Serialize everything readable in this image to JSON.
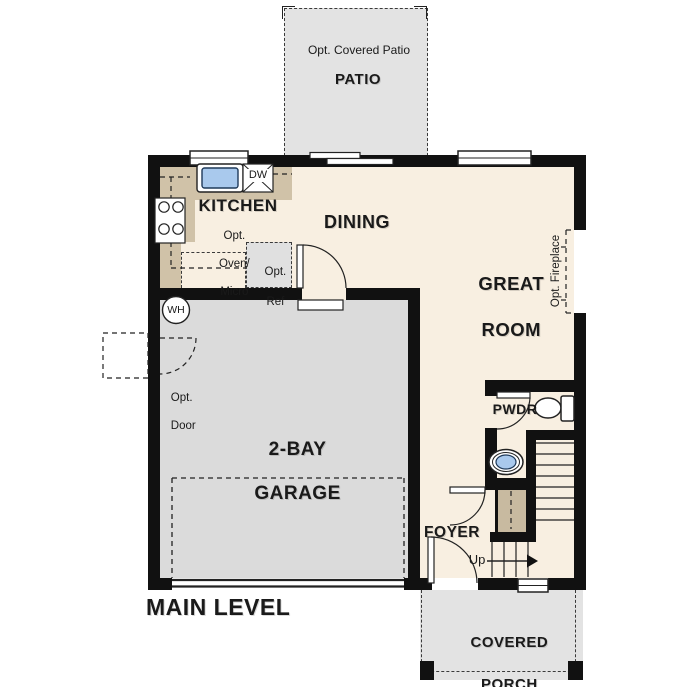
{
  "plan": {
    "title": "MAIN LEVEL",
    "kitchen": {
      "label": "KITCHEN",
      "note_line1": "Opt.",
      "note_line2": "Oven/",
      "note_line3": "Micro",
      "dw": "DW",
      "ref_line1": "Opt.",
      "ref_line2": "Ref"
    },
    "dining": {
      "label": "DINING"
    },
    "great_room": {
      "label_line1": "GREAT",
      "label_line2": "ROOM",
      "fireplace_note": "Opt. Fireplace"
    },
    "garage": {
      "label_line1": "2-BAY",
      "label_line2": "GARAGE",
      "water_heater": "WH",
      "opt_door_line1": "Opt.",
      "opt_door_line2": "Door"
    },
    "powder": {
      "label": "PWDR"
    },
    "foyer": {
      "label": "FOYER",
      "stairs_direction": "Up"
    },
    "patio": {
      "label": "PATIO",
      "note": "Opt. Covered Patio"
    },
    "porch": {
      "label_line1": "COVERED",
      "label_line2": "PORCH"
    }
  },
  "colors": {
    "wall": "#111111",
    "line": "#222222",
    "floor": "#f8efe1",
    "garage_floor": "#dbdbdb",
    "outdoor": "#e3e3e3",
    "counter": "#d0c2a8",
    "closet": "#c8baa0",
    "sink_blue": "#a9c9ed"
  }
}
